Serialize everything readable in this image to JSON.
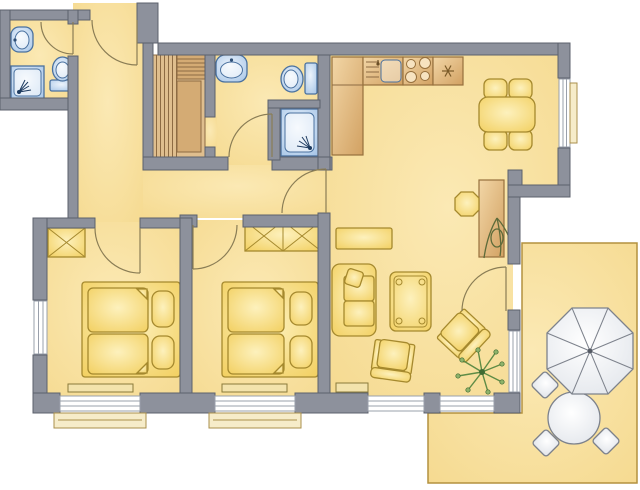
{
  "colors": {
    "floor": "#f5d98e",
    "floorHi": "#fbe9b4",
    "wall": "#8d919c",
    "wallStroke": "#5c616c",
    "wood": "#dfbe8e",
    "wood2": "#d4ab74",
    "woodLine": "#8d6b43",
    "counter1": "#f2d6a6",
    "counter2": "#d2a162",
    "counterStroke": "#96703d",
    "furn1": "#fdf1bd",
    "furn2": "#f2cf5f",
    "furnStroke": "#a5892e",
    "fix1": "#ecf3fb",
    "fix2": "#a9c7e8",
    "fixStroke": "#4a719f",
    "white1": "#ffffff",
    "white2": "#dfe3e9",
    "whiteStroke": "#7d828c",
    "winLine": "#9aa0ab",
    "sill": "#f6ecc9",
    "sillStroke": "#a98f4c",
    "arc": "#8a7d55",
    "terraceStroke": "#b3913f",
    "radiator": "#f3e3ac",
    "radiatorStroke": "#8a7a3a",
    "plant": "#5f8c46",
    "plantTip": "#8fb36a",
    "plantDark": "#3f6b33",
    "deskPlant": "#5d6b3a",
    "snow": "#7a5a28"
  },
  "plan": {
    "type": "apartment-floor-plan",
    "rooms": [
      {
        "id": "bathroom-1",
        "fixtures": [
          "washbasin",
          "shower",
          "toilet"
        ]
      },
      {
        "id": "entrance-hall",
        "fixtures": [
          "entrance-door"
        ]
      },
      {
        "id": "sauna",
        "fixtures": [
          "bench-slats",
          "upper-bench",
          "heater-cabinet"
        ]
      },
      {
        "id": "shower-room",
        "fixtures": [
          "washbasin",
          "toilet",
          "shower-cabin"
        ]
      },
      {
        "id": "kitchen",
        "fixtures": [
          "counter-cabinet",
          "sink-unit",
          "stove-4-burners",
          "refrigerator-snowflake"
        ]
      },
      {
        "id": "dining-area",
        "fixtures": [
          "dining-table",
          "chair",
          "chair",
          "chair",
          "chair",
          "window"
        ]
      },
      {
        "id": "living-room",
        "fixtures": [
          "sideboard",
          "sofa",
          "cushion",
          "coffee-table",
          "armchair",
          "armchair",
          "desk",
          "desk-chair",
          "desk-plant",
          "floor-plant",
          "radiator",
          "windows",
          "terrace-door"
        ]
      },
      {
        "id": "bedroom-1",
        "fixtures": [
          "wardrobe-x",
          "double-bed",
          "pillows",
          "radiator",
          "window-bottom",
          "window-left"
        ]
      },
      {
        "id": "bedroom-2",
        "fixtures": [
          "wardrobe-double-x",
          "double-bed",
          "pillows",
          "radiator",
          "window-bottom"
        ]
      },
      {
        "id": "terrace",
        "fixtures": [
          "parasol",
          "round-table",
          "chair",
          "chair",
          "chair"
        ]
      }
    ],
    "doors": [
      "entrance",
      "bathroom-1",
      "shower-room",
      "sauna-opening",
      "bedroom-1",
      "bedroom-2",
      "corridor-living",
      "terrace"
    ]
  }
}
